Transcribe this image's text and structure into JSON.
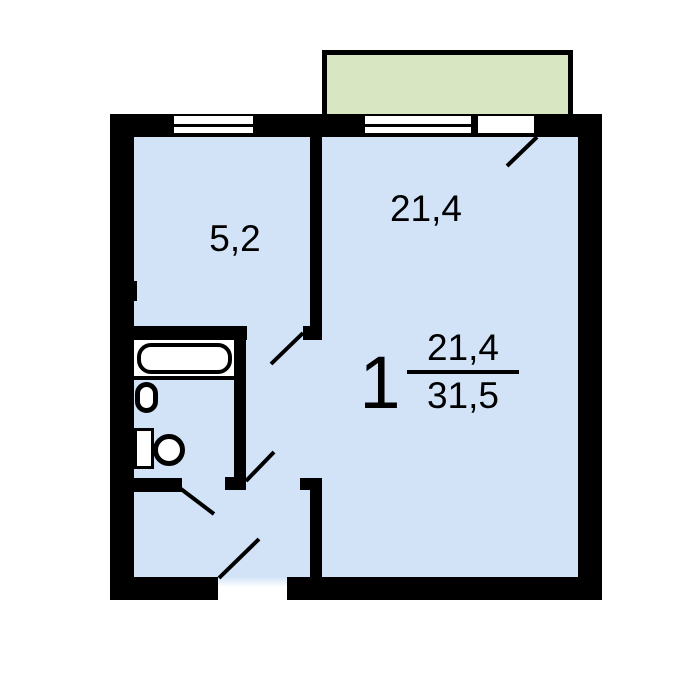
{
  "colors": {
    "floor": "#d2e3f8",
    "balcony": "#d8e6c2",
    "wall": "#000000",
    "fixture": "#ffffff",
    "text": "#000000",
    "background": "#ffffff"
  },
  "plan": {
    "kitchen": {
      "area_label": "5,2"
    },
    "living_room": {
      "area_label": "21,4"
    },
    "summary": {
      "rooms_count": "1",
      "living_area": "21,4",
      "total_area": "31,5"
    },
    "fixtures": [
      {
        "name": "bathtub"
      },
      {
        "name": "sink"
      },
      {
        "name": "toilet"
      },
      {
        "name": "balcony"
      },
      {
        "name": "kitchen-window"
      },
      {
        "name": "living-room-window"
      },
      {
        "name": "balcony-door"
      }
    ]
  }
}
